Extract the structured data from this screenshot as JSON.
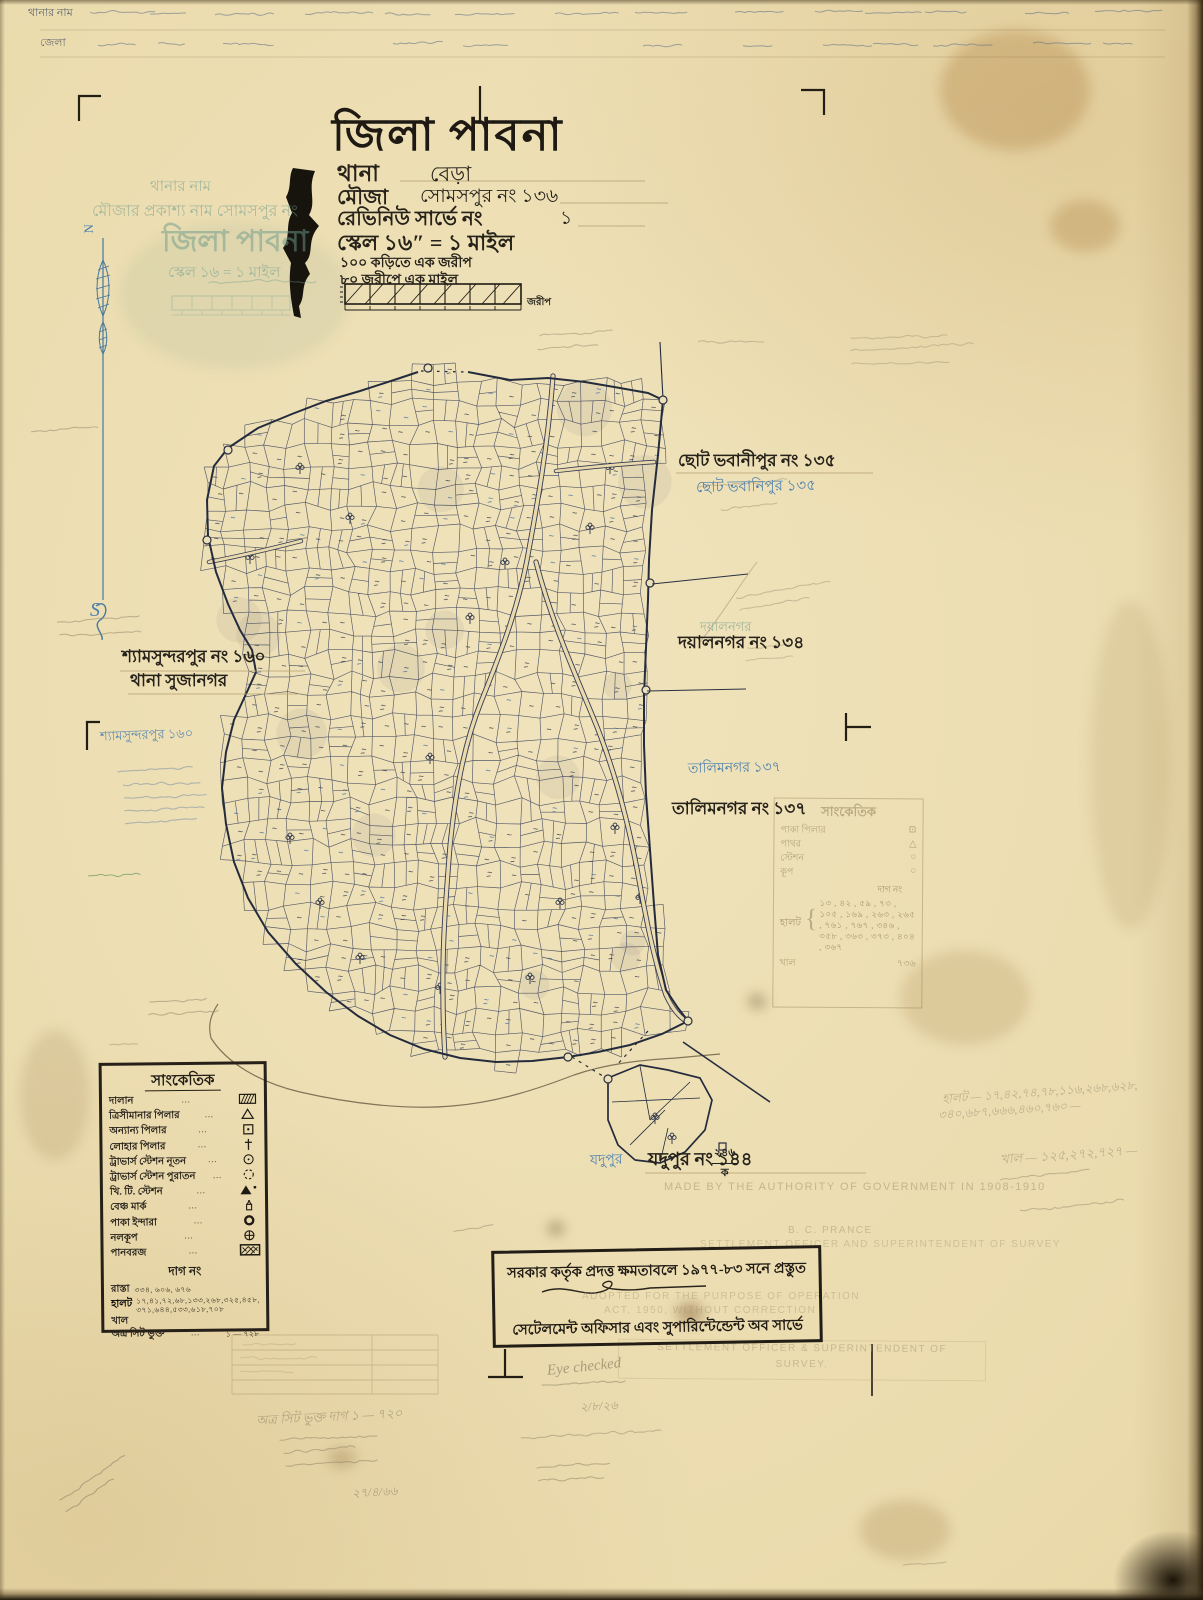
{
  "title_block": {
    "district": "জিলা পাবনা",
    "thana_label": "থানা",
    "thana_value": "বেড়া",
    "mouza_label": "মৌজা",
    "mouza_value": "সোমসপুর নং ১৩৬",
    "revenue_label": "রেভিনিউ সার্ভে নং",
    "revenue_value": "১",
    "scale_line": "স্কেল ১৬″ = ১ মাইল",
    "sub_line1": "১০০ কড়িতে এক জরীপ",
    "sub_line2": "৮০ জরীপে এক মাইল",
    "scalebar_unit": "জরীপ"
  },
  "compass": {
    "north": "N",
    "south": "S"
  },
  "ghost_title": {
    "line1": "থানার নাম",
    "line2": "মৌজার প্রকাশ্য নাম সোমসপুর নং",
    "line3": "জিলা পাবনা",
    "line4": "স্কেল ১৬ = ১ মাইল"
  },
  "top_table": {
    "r1c1": "থানার নাম",
    "r2c1": "জেলা"
  },
  "neighbour_labels": {
    "chhoto_bhabanipur": {
      "printed": "ছোট ভবানীপুর নং ১৩৫",
      "handwritten": "ছোট ভবানিপুর ১৩৫"
    },
    "dayalnagar": {
      "printed": "দয়ালনগর নং ১৩৪",
      "stamp": "দয়ালনগর"
    },
    "shyamsundarpur": {
      "printed": "শ্যামসুন্দরপুর নং ১৬০",
      "printed2": "থানা সুজানগর",
      "handwritten": "শ্যামসুন্দরপুর ১৬০"
    },
    "talimnagar": {
      "printed": "তালিমনগর নং ১৩৭",
      "handwritten": "তালিমনগর ১৩৭"
    },
    "jadupur": {
      "printed": "যদুপুর নং ১৪৪",
      "handwritten": "যদুপুর"
    }
  },
  "map": {
    "detached_num": "২৪৬",
    "detached_sub": "ক"
  },
  "legend": {
    "title": "সাংকেতিক",
    "dots": "···",
    "rows": [
      {
        "label": "দালান",
        "symbol": "building-hatch"
      },
      {
        "label": "ত্রিসীমানার পিলার",
        "symbol": "triangle"
      },
      {
        "label": "অন্যান্য পিলার",
        "symbol": "square-dot"
      },
      {
        "label": "লোহার পিলার",
        "symbol": "iron-cross"
      },
      {
        "label": "ট্রাভার্স স্টেশন নূতন",
        "symbol": "circle-dot"
      },
      {
        "label": "ট্রাভার্স স্টেশন পুরাতন",
        "symbol": "circle-dashed"
      },
      {
        "label": "খি. টি. স্টেশন",
        "symbol": "triangle-solid-dot"
      },
      {
        "label": "বেঞ্চ মার্ক",
        "symbol": "benchmark"
      },
      {
        "label": "পাকা ইন্দারা",
        "symbol": "ring"
      },
      {
        "label": "নলকূপ",
        "symbol": "circle-plus"
      },
      {
        "label": "পানবরজ",
        "symbol": "pan-hatch"
      }
    ],
    "dag_header": "দাগ নং",
    "dag_rows": [
      {
        "label": "রাস্তা",
        "values": "৩৩৪, ৬০৬, ৬৭৬",
        "values2": ""
      },
      {
        "label": "হালট",
        "values": "১৭,৪১,৭২,৬৮,১৩৩,২৬৮,৩২৫,৪৫৮,",
        "values2": "৩৭১,৬৪৪,৫৩৩,৬১৮,৭০৮"
      },
      {
        "label": "খাল",
        "values": "",
        "values2": ""
      },
      {
        "label": "অত্র সিট ভুক্ত",
        "values": "১ — ৭২৮",
        "values2": ""
      }
    ]
  },
  "ghost_legend": {
    "title": "সাংকেতিক",
    "rows": [
      {
        "label": "পাকা পিলার",
        "glyph": "⊡"
      },
      {
        "label": "পাথর",
        "glyph": "△"
      },
      {
        "label": "স্টেশন",
        "glyph": "○"
      },
      {
        "label": "কূপ",
        "glyph": "○"
      }
    ],
    "dag_header": "দাগ নং",
    "halot_label": "হালট",
    "halot_values": "১৩ , ৪২ , ৫৯ , ৭৩ , ১০৫ , ১৬৯ , ২৬৩ , ২৬৫ , ৭৬১ , ৭৬৭ , ৩৪৬ , ৩৫৮ , ৩৬৩ , ৩৭৩ , ৪০৪ , ৩৬৭",
    "khal_label": "খাল",
    "khal_value": "৭৩৬"
  },
  "stamp_box": {
    "line1": "সরকার কর্তৃক প্রদত্ত ক্ষমতাবলে ১৯৭৭-৮৩ সনে প্রস্তুত",
    "line2": "সেটেলমেন্ট অফিসার এবং সুপারিন্টেন্ডেন্ট অব সার্ভে"
  },
  "faint_stamps": {
    "made_by": "MADE BY THE AUTHORITY OF GOVERNMENT IN 1908-1910",
    "prance": "B. C. PRANCE",
    "settlement1": "SETTLEMENT OFFICER AND SUPERINTENDENT OF SURVEY",
    "adopted1": "ADOPTED FOR THE PURPOSE OF OPERATION",
    "adopted2": "ACT, 1950, WITHOUT CORRECTION",
    "settlement2_l1": "SETTLEMENT OFFICER & SUPERINTENDENT OF",
    "settlement2_l2": "SURVEY."
  },
  "pencil_notes": {
    "eye_checked": "Eye checked",
    "checked_date": "২/৮/২৬",
    "sheet_note": "অত্র সিট ভুক্ত দাগ ১ — ৭২০",
    "sheet_date": "২৭/৪/৬৬",
    "halot_line1": "হালট — ১৭,৪২,৭৪,৭৮,১১৬,২৬৮,৬২৮,",
    "halot_line2": "৩৪০,৬৮৭,৬৬৬,৪৬০,৭৬০ —",
    "khal_line": "খাল — ১২৫,২৭২,৭২৭ —"
  }
}
